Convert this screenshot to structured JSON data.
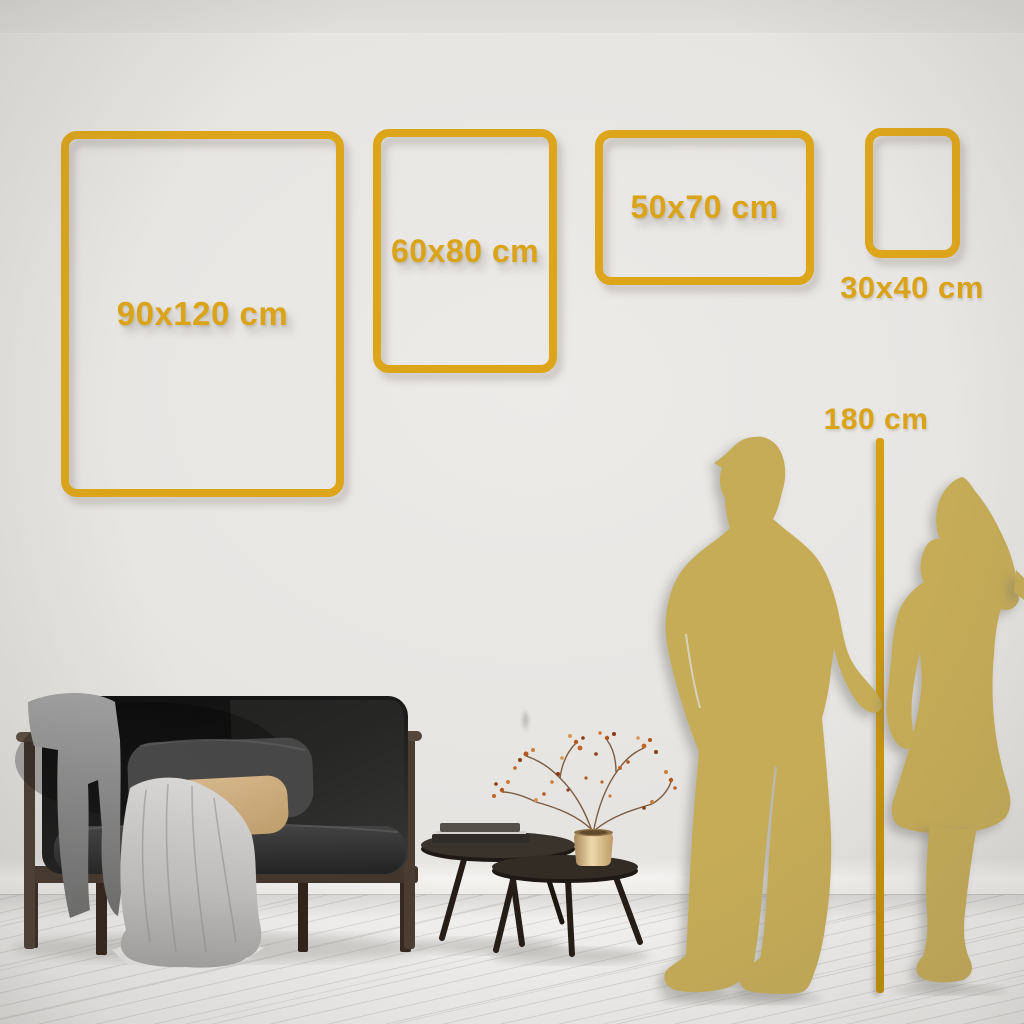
{
  "page": {
    "description": "Wall art size comparison scene with living room furniture and couple silhouettes"
  },
  "palette": {
    "accent_gold": "#DDA51A",
    "ruler_gold": "#C9960E",
    "silhouette_gold": "#C6AC57",
    "wall": "#E5E3E0",
    "floor": "#F2F1EF"
  },
  "size_guide": {
    "frames": [
      {
        "label": "90x120 cm"
      },
      {
        "label": "60x80 cm"
      },
      {
        "label": "50x70 cm"
      },
      {
        "label": "30x40 cm"
      }
    ],
    "reference_height": {
      "label": "180 cm"
    }
  },
  "scene": {
    "objects": [
      "dark sofa with wooden frame",
      "gray throw blanket",
      "gray back cushion",
      "tan pillow",
      "light drape cloth",
      "nesting coffee tables",
      "stacked books",
      "gold vase with dried branches",
      "man silhouette",
      "woman silhouette holding hands"
    ]
  }
}
